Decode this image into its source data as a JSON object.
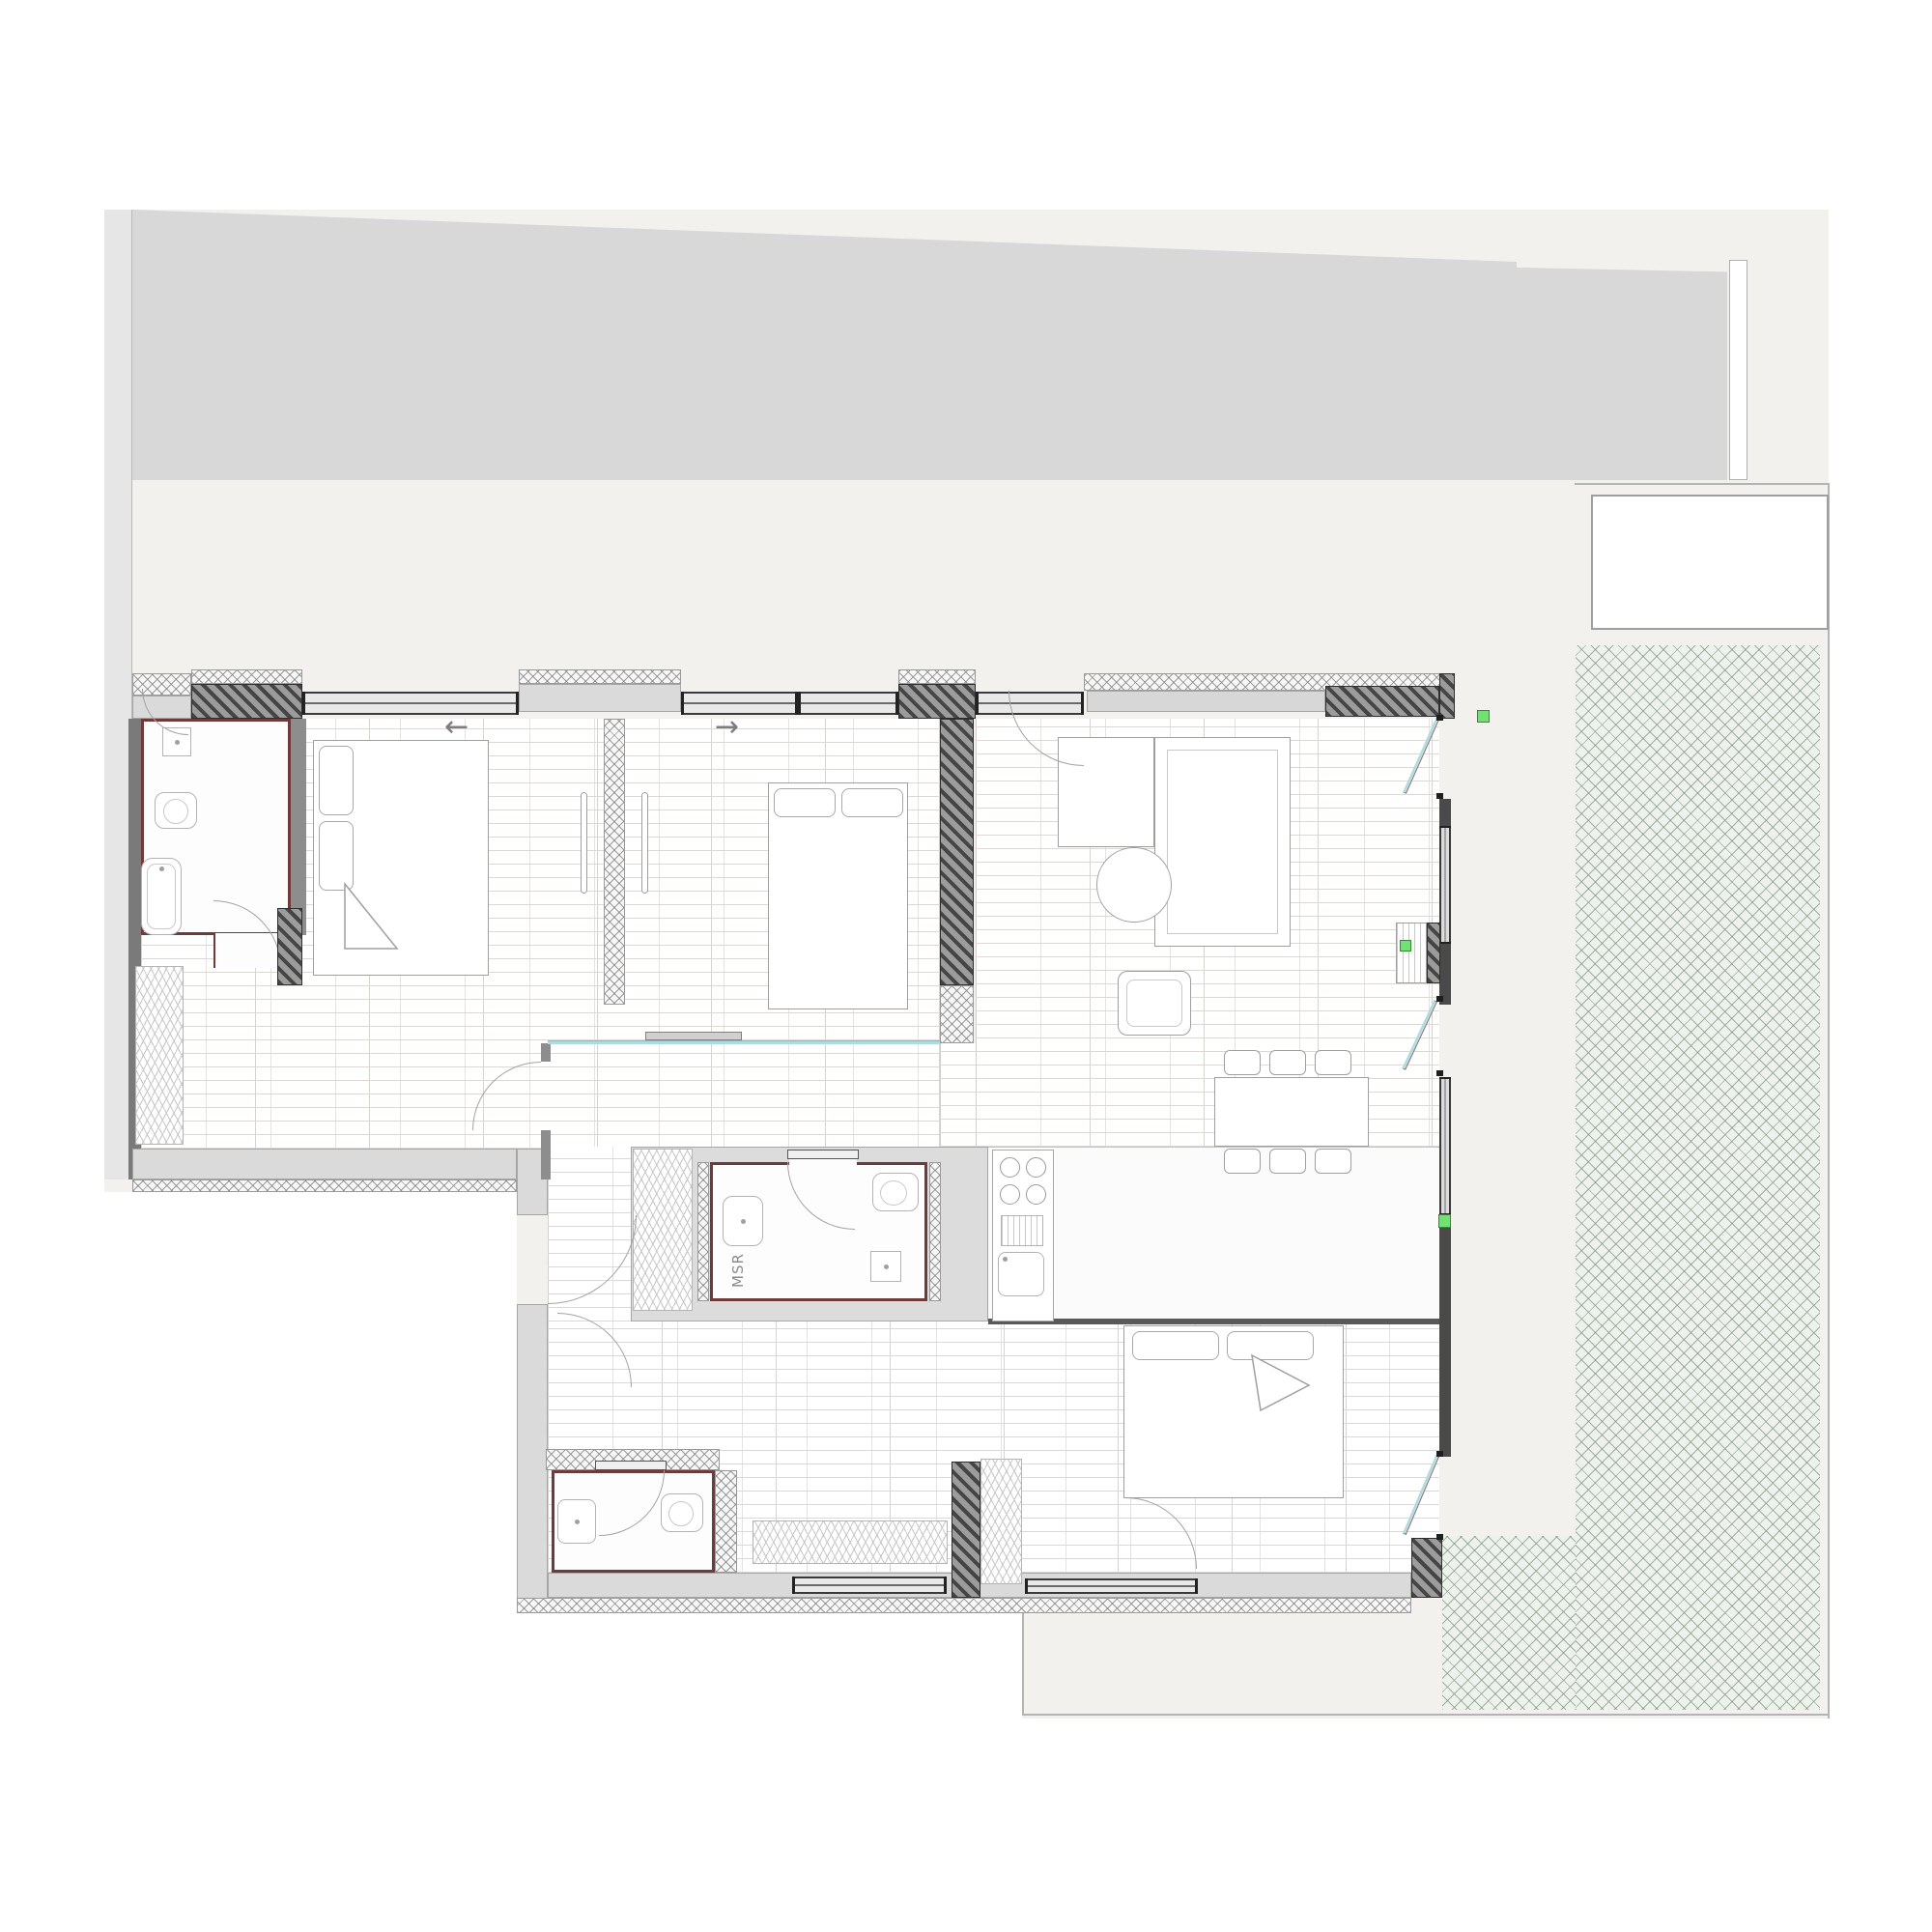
{
  "plan": {
    "labels": {
      "technical_room": "MSR"
    },
    "window_arrows": {
      "left": "←",
      "right": "→"
    },
    "colors": {
      "background": "#ffffff",
      "site": "#f2f1ee",
      "boundary_strip": "#e6e6e6",
      "neighbor_building": "#d8d8d8",
      "wall_dark": "#454545",
      "wall_mid": "#7a7a7a",
      "wall_light": "#dadada",
      "floor_line": "#dcd8d4",
      "bath_trim": "#6e3a3a",
      "glass_teal": "#aadde2",
      "terrace_bg": "#edf2ec",
      "accent_green": "#72e072"
    }
  }
}
